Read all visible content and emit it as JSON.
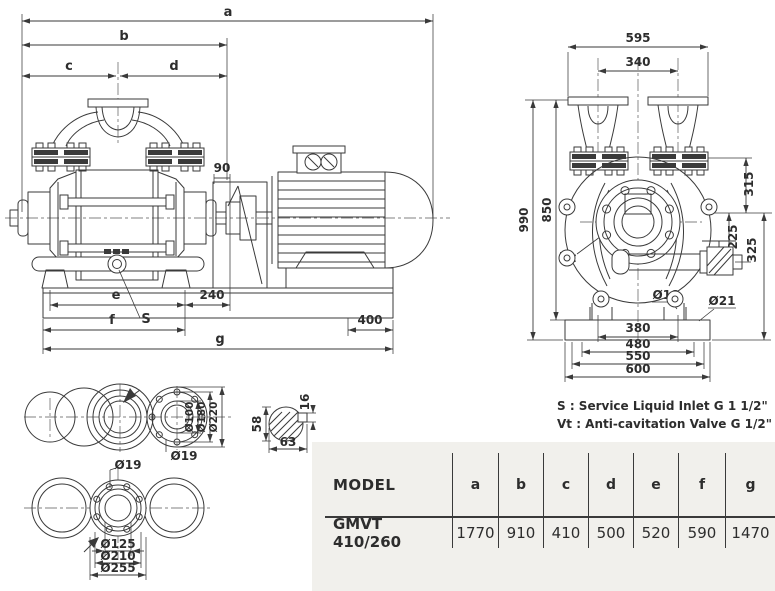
{
  "drawing": {
    "left_view": {
      "a": "a",
      "b": "b",
      "c": "c",
      "d": "d",
      "n90": "90",
      "n240": "240",
      "e": "e",
      "f": "f",
      "g": "g",
      "n400": "400",
      "s": "S"
    },
    "front_view": {
      "n595": "595",
      "n340": "340",
      "n990": "990",
      "n850": "850",
      "n315": "315",
      "n225": "225",
      "n325": "325",
      "vt": "Vt",
      "d18": "Ø18",
      "d21": "Ø21",
      "n380": "380",
      "n480": "480",
      "n550": "550",
      "n600": "600"
    },
    "ports_top": {
      "d100": "Ø100",
      "d180": "Ø180",
      "d220": "Ø220",
      "d19": "Ø19"
    },
    "ports_bottom": {
      "d19": "Ø19",
      "d125": "Ø125",
      "d210": "Ø210",
      "d255": "Ø255"
    },
    "shaft": {
      "n58": "58",
      "n63": "63",
      "n16": "16"
    }
  },
  "notes": {
    "s": "S  : Service Liquid Inlet G 1 1/2\"",
    "vt": "Vt : Anti-cavitation Valve  G 1/2\""
  },
  "table": {
    "headers": [
      "MODEL",
      "a",
      "b",
      "c",
      "d",
      "e",
      "f",
      "g"
    ],
    "row": [
      "GMVT 410/260",
      "1770",
      "910",
      "410",
      "500",
      "520",
      "590",
      "1470"
    ]
  },
  "colors": {
    "line": "#3a3a3a",
    "panel_bg": "#f1f0ec"
  }
}
